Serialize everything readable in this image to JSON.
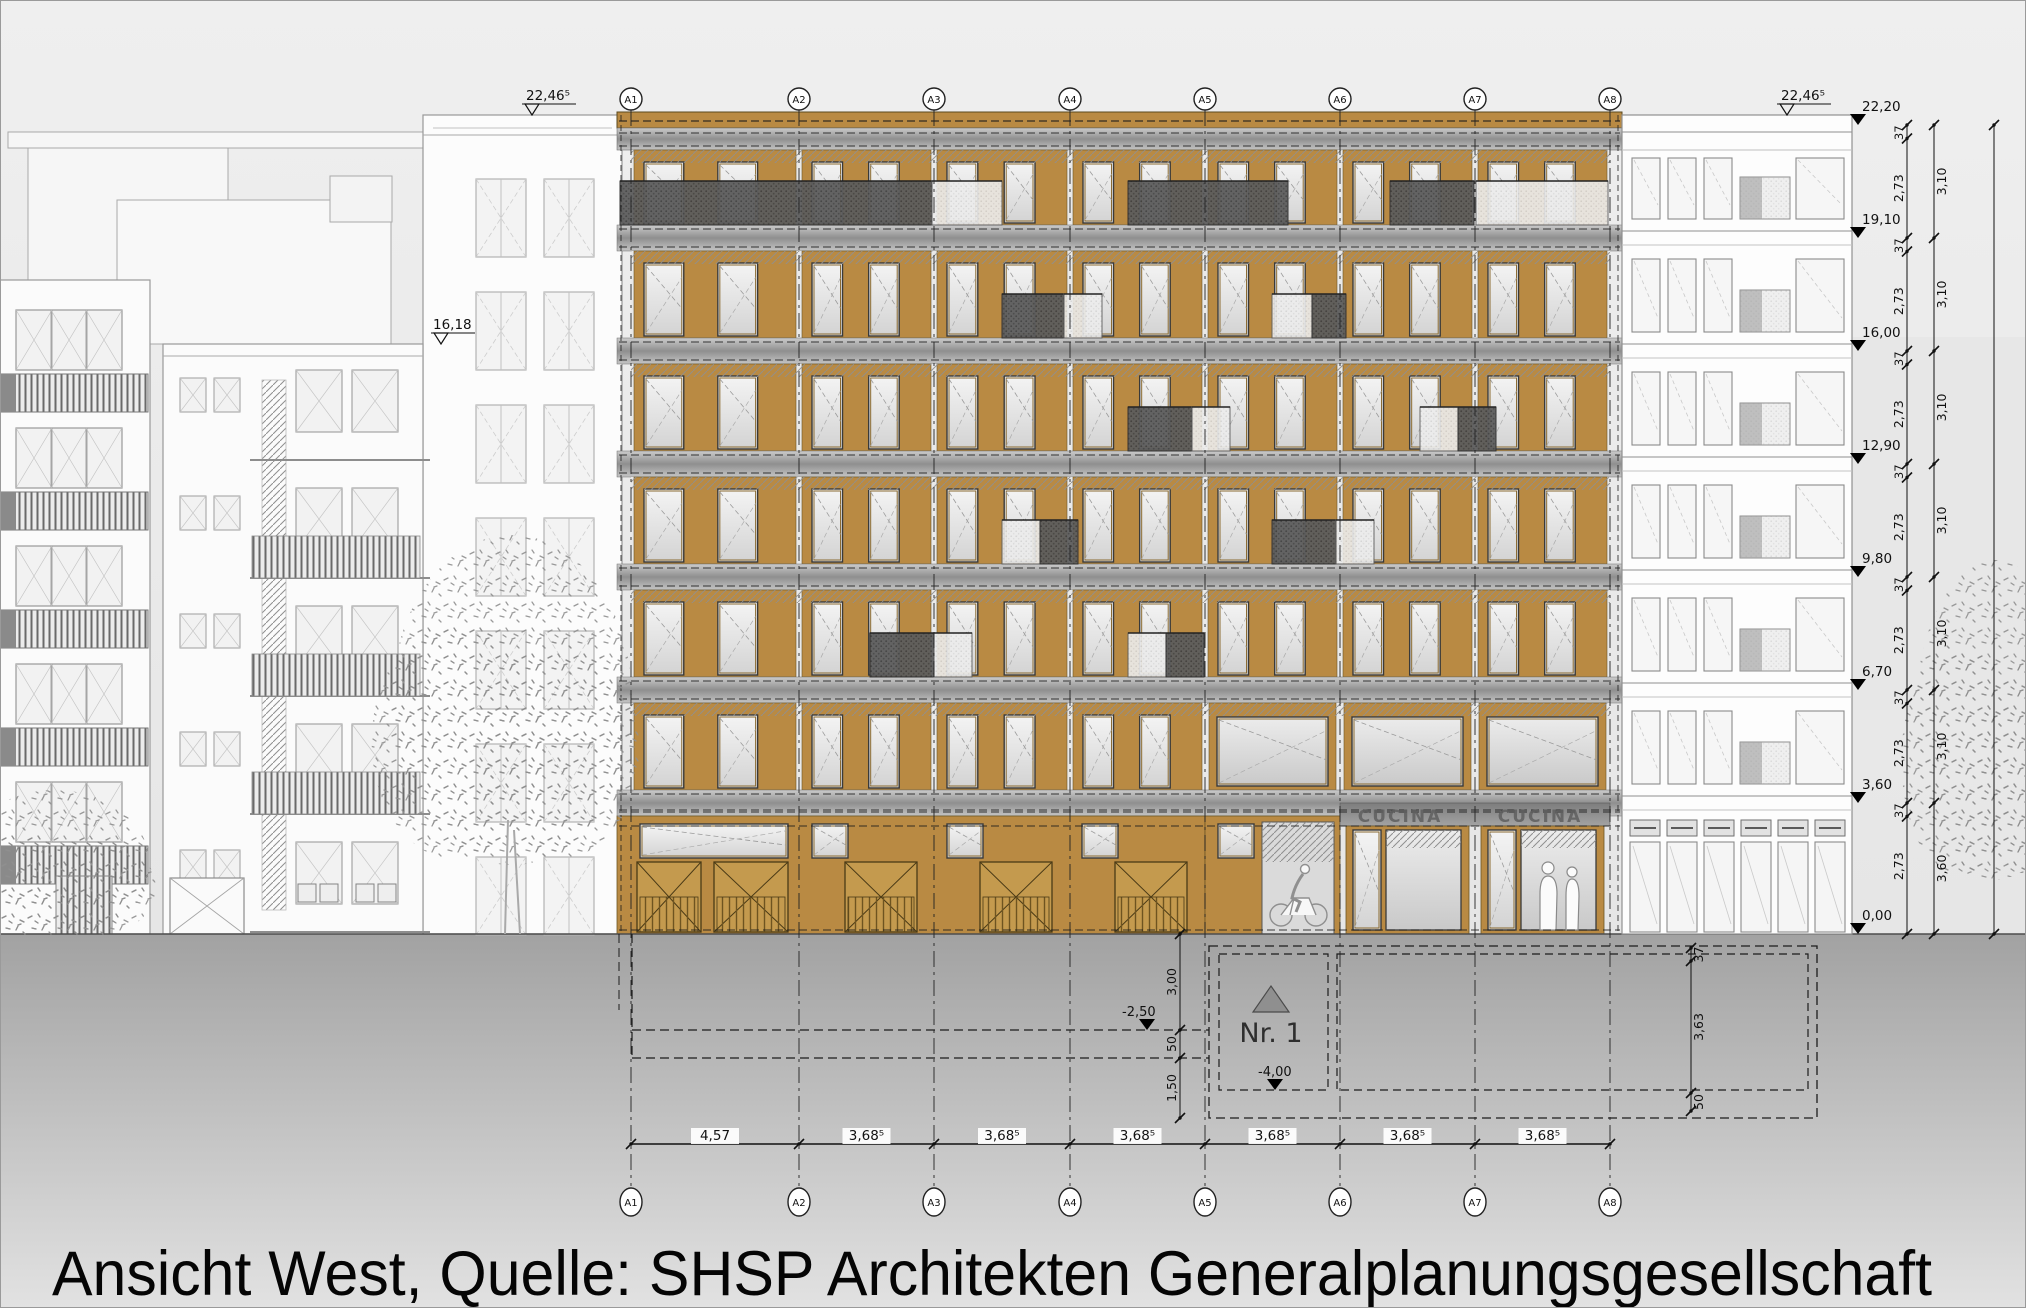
{
  "caption": "Ansicht West, Quelle: SHSP Architekten Generalplanungsgesellschaft",
  "drawing": {
    "axes": [
      "A1",
      "A2",
      "A3",
      "A4",
      "A5",
      "A6",
      "A7",
      "A8"
    ],
    "axis_spacings": [
      "4,57",
      "3,68⁵",
      "3,68⁵",
      "3,68⁵",
      "3,68⁵",
      "3,68⁵",
      "3,68⁵"
    ],
    "elevation_markers_right": [
      {
        "label": "22,20",
        "meters": 22.2
      },
      {
        "label": "19,10",
        "meters": 19.1
      },
      {
        "label": "16,00",
        "meters": 16.0
      },
      {
        "label": "12,90",
        "meters": 12.9
      },
      {
        "label": "9,80",
        "meters": 9.8
      },
      {
        "label": "6,70",
        "meters": 6.7
      },
      {
        "label": "3,60",
        "meters": 3.6
      },
      {
        "label": "0,00",
        "meters": 0.0
      }
    ],
    "roof_marker_left": {
      "label": "22,46⁵"
    },
    "roof_marker_right": {
      "label": "22,46⁵"
    },
    "neighbor_roof_marker": {
      "label": "16,18",
      "meters": 16.18
    },
    "storey_dims": {
      "slab": "37",
      "clear": "2,73",
      "storey": "3,10",
      "ground_storey": "3,60"
    },
    "basement": {
      "unit_label": "Nr. 1",
      "level_markers": [
        {
          "label": "-2,50"
        },
        {
          "label": "-4,00"
        }
      ],
      "left_chain": [
        "3,00",
        "50",
        "1,50"
      ],
      "right_chain": [
        "37",
        "3,63",
        "50"
      ]
    },
    "signs": {
      "kitchen": "CUCINA"
    }
  },
  "colors": {
    "wood": "#b98a43",
    "wood_dark": "#a4762f",
    "slab": "#9a9a9a",
    "balcony_dark": "#5a5a5a",
    "line": "#1c1c1c",
    "sky": "#ededed",
    "ground_top": "#a5a5a5",
    "ground_bottom": "#dedede"
  }
}
